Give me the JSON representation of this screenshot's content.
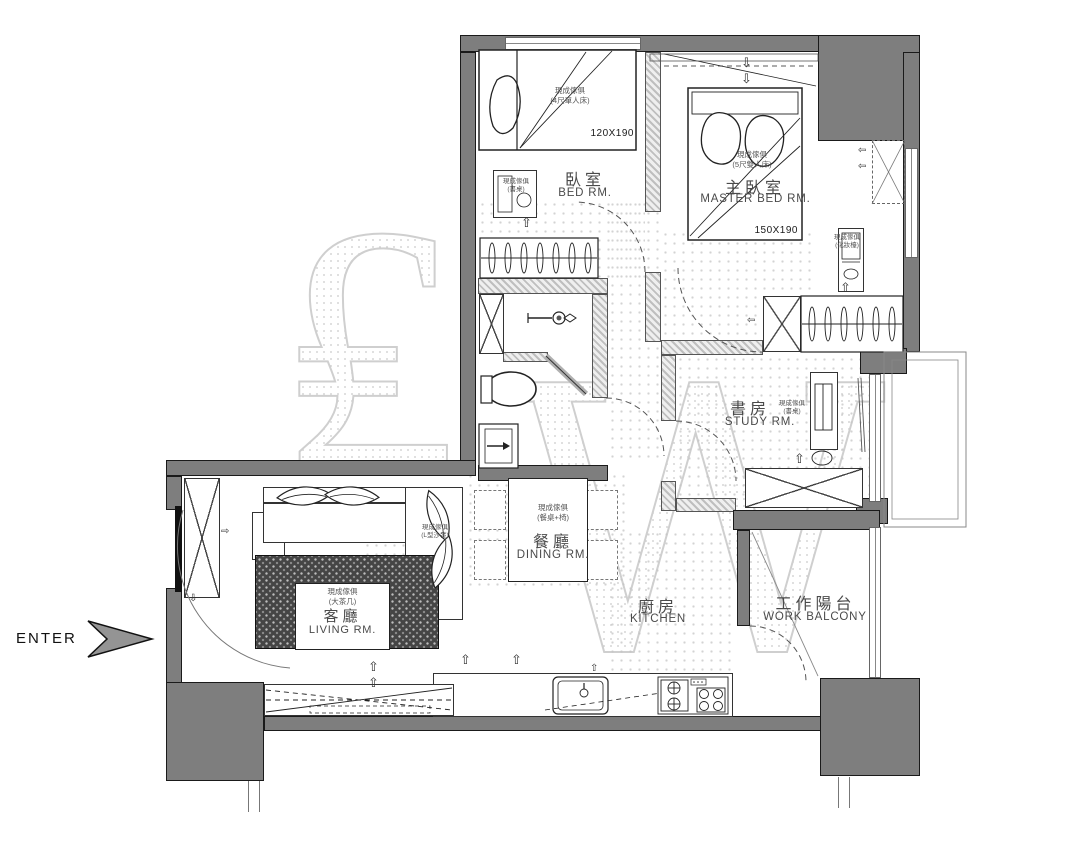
{
  "plan": {
    "enter_label": "ENTER",
    "watermark_letters": {
      "first": "₤",
      "second": "W"
    },
    "rooms": {
      "bedroom": {
        "name_zh": "臥室",
        "name_en": "BED RM.",
        "bed_dim": "120X190",
        "bed_note_1": "現成傢俱",
        "bed_note_2": "(4尺單人床)",
        "desk_note_1": "現成傢俱",
        "desk_note_2": "(書桌)"
      },
      "master_bedroom": {
        "name_zh": "主臥室",
        "name_en": "MASTER BED RM.",
        "bed_dim": "150X190",
        "bed_note_1": "現成傢俱",
        "bed_note_2": "(5尺雙人床)",
        "vanity_note_1": "現成傢俱",
        "vanity_note_2": "(化妝檯)"
      },
      "study": {
        "name_zh": "書房",
        "name_en": "STUDY RM.",
        "desk_note_1": "現成傢俱",
        "desk_note_2": "(書桌)"
      },
      "dining": {
        "name_zh": "餐廳",
        "name_en": "DINING RM.",
        "note_1": "現成傢俱",
        "note_2": "(餐桌+椅)"
      },
      "living": {
        "name_zh": "客廳",
        "name_en": "LIVING RM.",
        "table_note_1": "現成傢俱",
        "table_note_2": "(大茶几)",
        "sofa_note_1": "現成傢俱",
        "sofa_note_2": "(L型沙發)"
      },
      "kitchen": {
        "name_zh": "廚房",
        "name_en": "KITCHEN"
      },
      "balcony": {
        "name_zh": "工作陽台",
        "name_en": "WORK BALCONY"
      }
    },
    "icons": {
      "up_arrow": "⇧",
      "down_arrow": "⇩",
      "left_arrow": "⇦",
      "right_arrow": "⇨"
    },
    "colors": {
      "wall_fill": "#7e7e7e",
      "wall_edge": "#1a1a1a",
      "hatch": "#c9c9c9",
      "watermark": "#cfcfcf",
      "label_text": "#4f4f4f",
      "rug": "#454545"
    }
  }
}
